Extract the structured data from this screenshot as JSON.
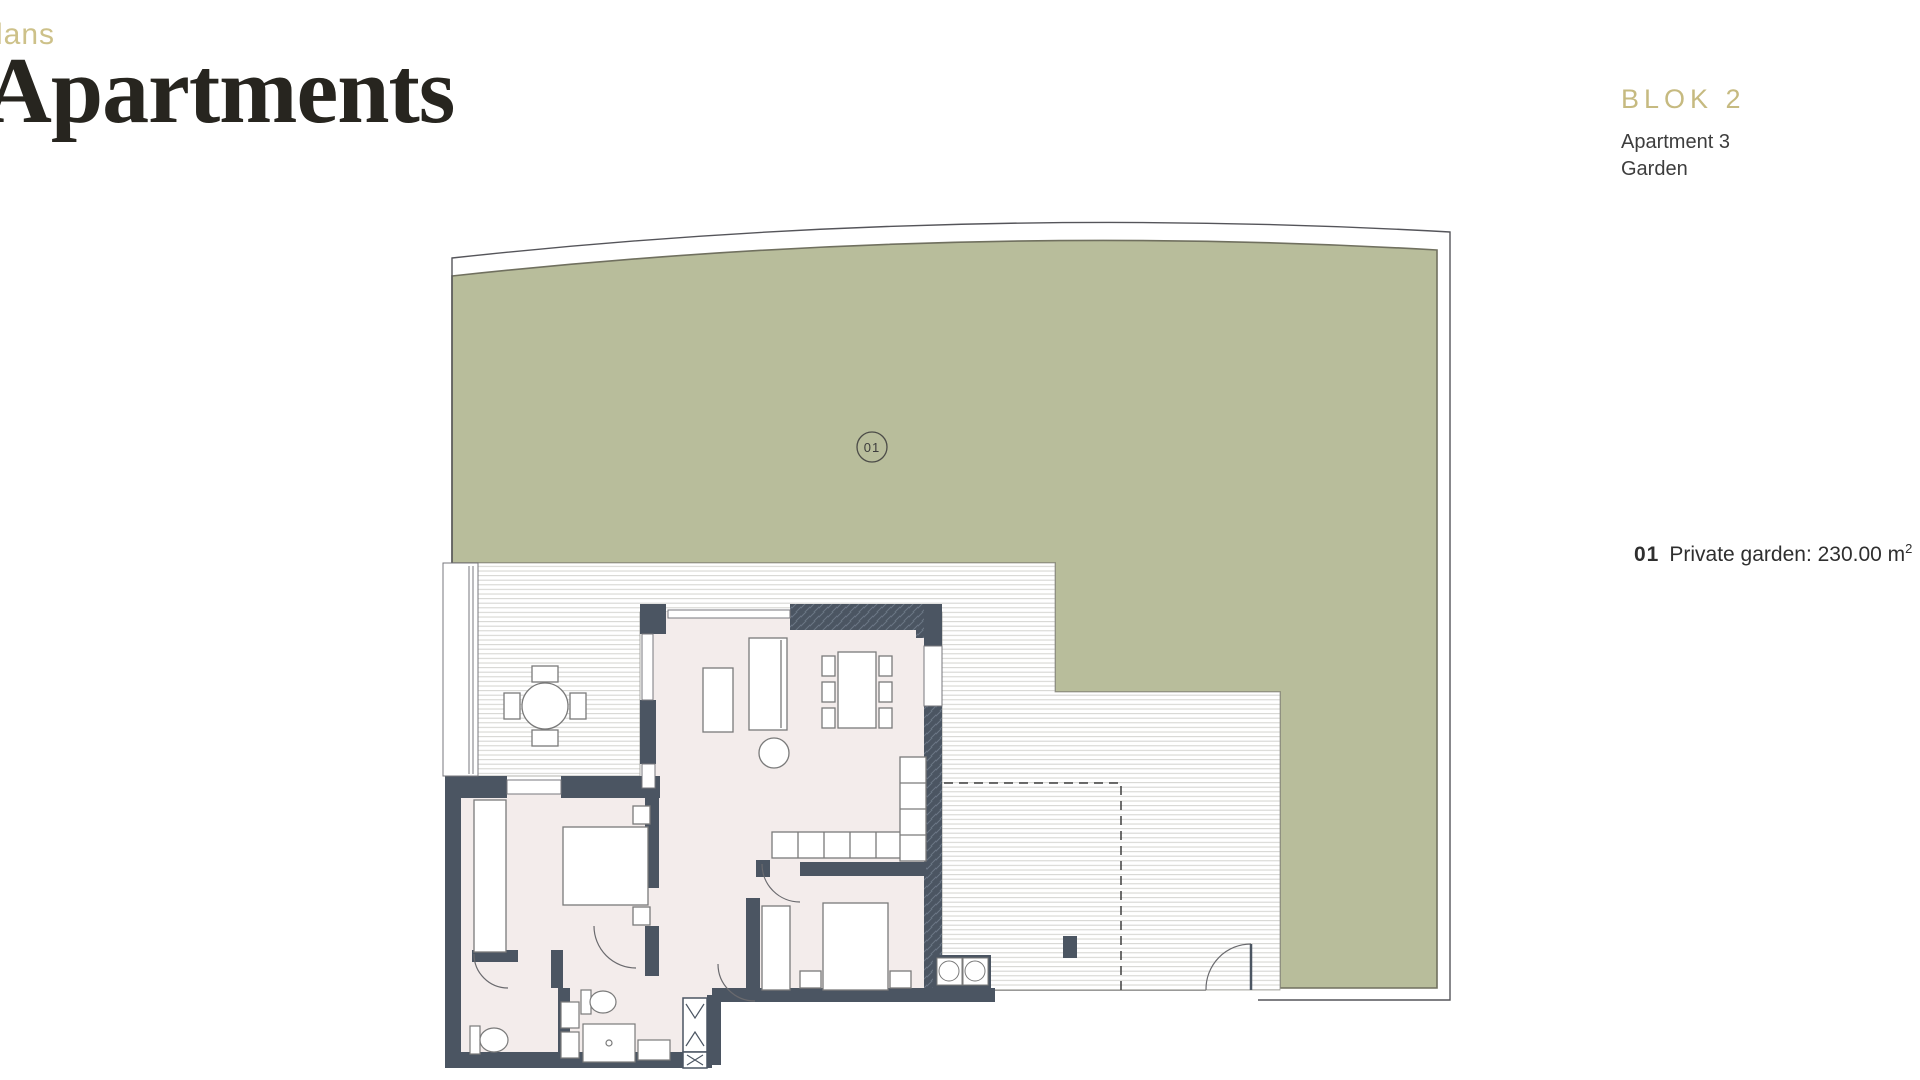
{
  "header": {
    "kicker": "lans",
    "title": "Apartments"
  },
  "plan_info": {
    "block": "BLOK 2",
    "apartment": "Apartment 3",
    "type": "Garden"
  },
  "legend": {
    "item_number": "01",
    "label": "Private garden: 230.00 m",
    "superscript": "2"
  },
  "floorplan": {
    "garden_label": "01",
    "garden_area_m2": "230.00",
    "colors": {
      "garden": "#b8bd9b",
      "garden_outline": "#70705f",
      "wall": "#4b5562",
      "floor": "#f3eceb",
      "stripe": "#d3d3cf",
      "thin_line": "#55555a",
      "accent_gold": "#c6ba80",
      "text": "#3d3d3d"
    }
  }
}
